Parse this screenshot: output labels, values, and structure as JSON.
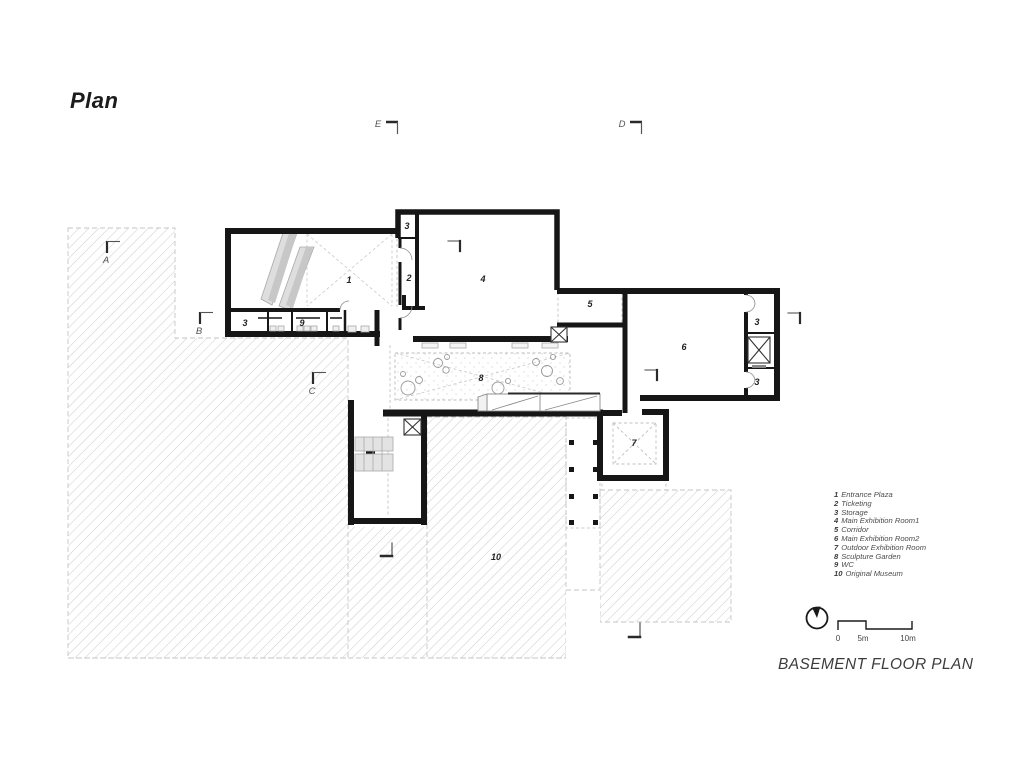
{
  "title": "Plan",
  "drawing_title": "BASEMENT FLOOR PLAN",
  "section_markers": {
    "a": "A",
    "b": "B",
    "c": "C",
    "d": "D",
    "e": "E"
  },
  "legend": {
    "items": [
      {
        "num": "1",
        "name": "Entrance Plaza"
      },
      {
        "num": "2",
        "name": "Ticketing"
      },
      {
        "num": "3",
        "name": "Storage"
      },
      {
        "num": "4",
        "name": "Main Exhibition Room1"
      },
      {
        "num": "5",
        "name": "Corridor"
      },
      {
        "num": "6",
        "name": "Main Exhibition Room2"
      },
      {
        "num": "7",
        "name": "Outdoor Exhibition Room"
      },
      {
        "num": "8",
        "name": "Sculpture Garden"
      },
      {
        "num": "9",
        "name": "WC"
      },
      {
        "num": "10",
        "name": "Original Museum"
      }
    ]
  },
  "scale_bar": {
    "zero": "0",
    "five": "5m",
    "ten": "10m"
  },
  "colors": {
    "wall": "#161616",
    "hatch": "#cccccc",
    "gray_fill": "#d8d8d8",
    "text": "#4c4c4c"
  }
}
